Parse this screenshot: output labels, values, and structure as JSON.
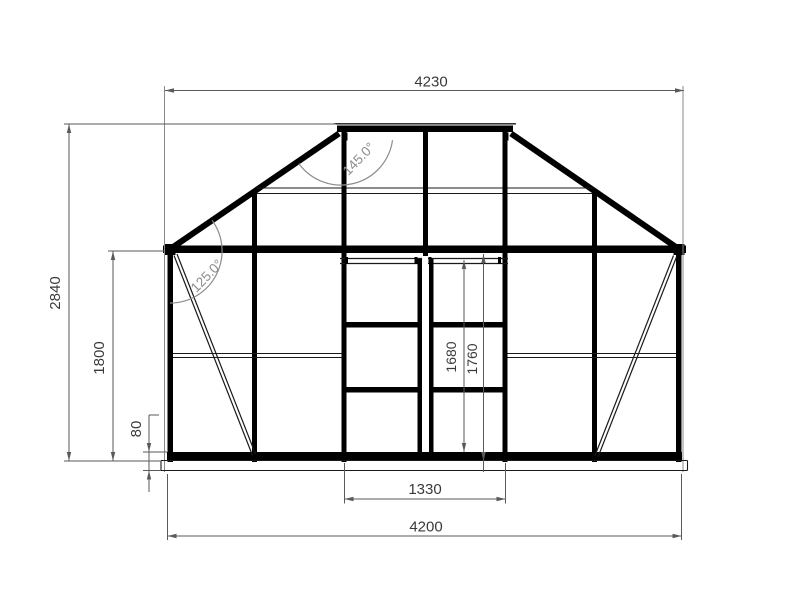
{
  "drawing": {
    "dimensions": {
      "top_width": "4230",
      "overall_height": "2840",
      "eave_height": "1800",
      "base_height": "80",
      "door_width": "1330",
      "bottom_width": "4200",
      "door_height": "1680",
      "door_opening_height": "1760"
    },
    "angles": {
      "ridge": "145.0°",
      "eave": "125.0°"
    },
    "colors": {
      "background": "#ffffff",
      "frame_line": "#000000",
      "thin_line": "#1a1a1a",
      "dim_line": "#5a5a5a",
      "dim_text": "#3a3a3a",
      "angle_text": "#8c8c8c"
    }
  }
}
